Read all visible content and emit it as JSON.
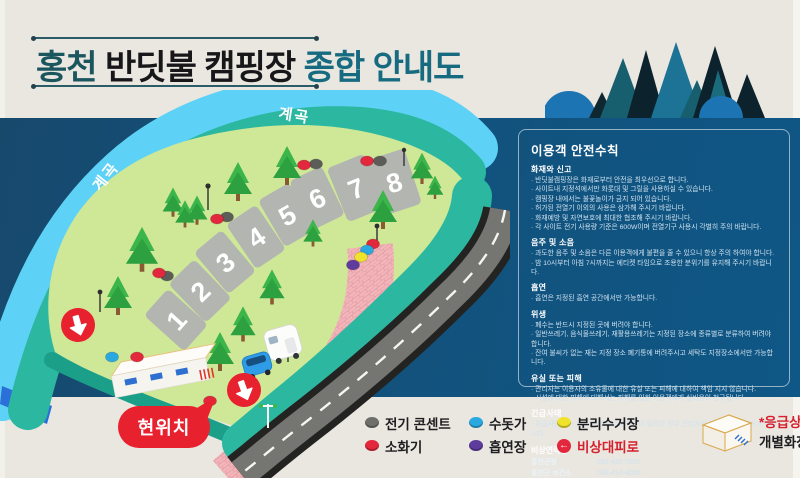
{
  "title": {
    "part1": "홍천",
    "part2": " 반딧불 캠핑장",
    "part3": " 종합 안내도"
  },
  "map": {
    "stream_labels": [
      "계곡",
      "계곡"
    ],
    "sites": [
      "1",
      "2",
      "3",
      "4",
      "5",
      "6",
      "7",
      "8"
    ],
    "current_location": "현위치"
  },
  "safety": {
    "heading": "이용객 안전수칙",
    "sections": [
      {
        "title": "화재와 신고",
        "items": [
          "반딧불캠핑장은 화재로부터 안전을 최우선으로 합니다.",
          "사이트내 지정석에서만 화롯대 및 그릴을 사용하실 수 있습니다.",
          "캠핑장 내에서는 불꽃놀이가 금지 되어 있습니다.",
          "허가된 전열기 이외의 사용은 삼가해 주시기 바랍니다.",
          "화재예방 및 자연보호에 최대한 협조해 주시기 바랍니다.",
          "각 사이트 전기 사용량 기준은 600W이며 전열기구 사용시 각별히 주의 바랍니다."
        ]
      },
      {
        "title": "음주 및 소음",
        "items": [
          "과도한 음주 및 소음은 다른 이용객에게 불편을 줄 수 있으니 항상 주의 하여야 합니다.",
          "밤 10시부터 아침 7시까지는 에티켓 타임으로 조용한 분위기를 유지해 주시기 바랍니다."
        ]
      },
      {
        "title": "흡연",
        "items": [
          "흡연은 지정된 흡연 공간에서만 가능합니다."
        ]
      },
      {
        "title": "위생",
        "items": [
          "폐수는 반드시 지정된 곳에 버려야 합니다.",
          "일반쓰레기, 음식물쓰레기, 재활용쓰레기는 지정된 장소에 종류별로 분류하여 버려야 합니다.",
          "잔여 불씨가 없는 재는 지정 장소 폐기통에 버려주시고 세탁도 지정장소에서만 가능합니다."
        ]
      },
      {
        "title": "유실 또는 피해",
        "items": [
          "관리자는 이용자의 소유물에 대한 유실 또는 피해에 대하여 책임 지지 않습니다.",
          "시설에 대한 피해에 대해서는 피해를 입힌 이용객에게 실비용이 청구됩니다."
        ]
      },
      {
        "title": "긴급사태",
        "items": [
          "위급사항 또는 호우/강풍 등으로 피난이 필요한 경우 관리자의 지시에 따라 주시기 바랍니다."
        ]
      }
    ],
    "contacts": {
      "title": "비상연락망",
      "rows": [
        {
          "name": "홍천군청",
          "value": "033-432-7801"
        },
        {
          "name": "홍천군 보건소",
          "value": "033-434-4000"
        },
        {
          "name": "홍천 경찰서",
          "value": "033-434-3333 / 국번없이 182, 112"
        },
        {
          "name": "관리자",
          "value": "010-6322-5760 / 010-9282-1778"
        }
      ]
    }
  },
  "legend": {
    "items": [
      {
        "key": "electric-outlet",
        "label": "전기 콘센트",
        "color": "#6e6e6a",
        "icon": "dot"
      },
      {
        "key": "water-tap",
        "label": "수돗가",
        "color": "#2aa9e1",
        "icon": "dot"
      },
      {
        "key": "recycling-station",
        "label": "분리수거장",
        "color": "#efe32b",
        "icon": "dot"
      },
      {
        "key": "fire-extinguisher",
        "label": "소화기",
        "color": "#e3273d",
        "icon": "dot"
      },
      {
        "key": "smoking-area",
        "label": "흡연장",
        "color": "#5e3c9d",
        "icon": "dot"
      },
      {
        "key": "emergency-exit",
        "label": "비상대피로",
        "color": "#e3273d",
        "icon": "arrow-circle",
        "label_color": "#d6202c"
      }
    ],
    "facility": {
      "line1_red": "*응급상자",
      "line1_rest": " / 개수대",
      "line2": "개별화장실 / 매점"
    }
  },
  "colors": {
    "band_blue": "#12527d",
    "stream": "#5dd2f6",
    "bank": "#2cb8a0",
    "grass": "#cfe897",
    "road": "#757572",
    "path_pink": "#f2b6ba",
    "accent_red": "#e3273d",
    "title_teal": "#176b80"
  }
}
